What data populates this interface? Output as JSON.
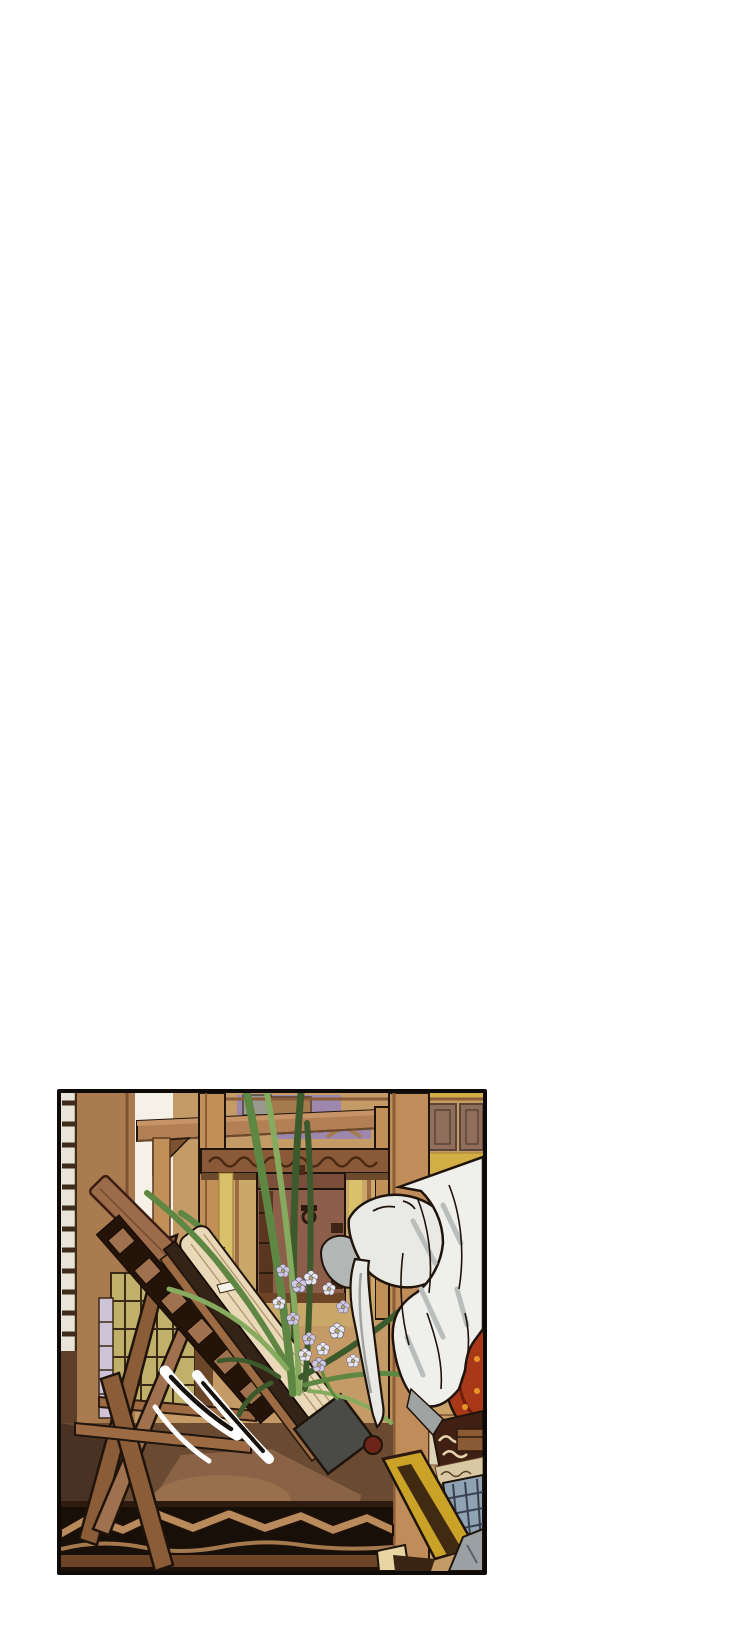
{
  "page": {
    "kind": "webtoon-episode-page",
    "background": "#ffffff"
  },
  "panel": {
    "kind": "comic-illustration-panel",
    "description": "A pale gloved hand reaches down to touch a thick closed book resting on a tilted wooden reading stand; long orchid leaves and small white and lavender flowers rise behind it inside a traditional wooden room with shelves, a latticed screen, a storage chest, a carved table edge, a yellow stool and an embroidered red object.",
    "border_color": "#0d0a07"
  },
  "scene": {
    "elements": [
      {
        "name": "lattice-screen",
        "label": "narrow white lattice screen on far left wall"
      },
      {
        "name": "wood-wall",
        "label": "brown wooden wall and pillar"
      },
      {
        "name": "white-wall",
        "label": "pale plaster wall strip"
      },
      {
        "name": "display-shelf",
        "label": "high wooden display shelf with boxes"
      },
      {
        "name": "stacked-boxes",
        "label": "gray, brown and purple boxes on the shelf"
      },
      {
        "name": "carved-frieze",
        "label": "carved scroll frieze under the shelf"
      },
      {
        "name": "storage-chest",
        "label": "dark wooden chest with metal fittings"
      },
      {
        "name": "wooden-column",
        "label": "tall foreground wooden column"
      },
      {
        "name": "paneled-wall",
        "label": "inset square wall panels over yellow band"
      },
      {
        "name": "orchid-plant",
        "label": "long arching orchid leaves"
      },
      {
        "name": "orchid-flowers",
        "label": "small white and lavender blossoms"
      },
      {
        "name": "reading-stand",
        "label": "tilted A-frame wooden book stand"
      },
      {
        "name": "book",
        "label": "thick closed book with cream page edges and dark cover"
      },
      {
        "name": "book-end-cap",
        "label": "dark gray tail end of the book"
      },
      {
        "name": "red-knob",
        "label": "small dark-red knob on the stand ledge"
      },
      {
        "name": "paper-tag",
        "label": "small white slip on the stand"
      },
      {
        "name": "motion-lines",
        "label": "white speed swooshes"
      },
      {
        "name": "reaching-hand",
        "label": "pale hand with extended index finger"
      },
      {
        "name": "white-sleeve",
        "label": "draped white sleeve"
      },
      {
        "name": "floor",
        "label": "brown floor with warm light patch"
      },
      {
        "name": "carved-table-edge",
        "label": "ornate carved wooden edge band"
      },
      {
        "name": "yellow-stool",
        "label": "slanted yellow stool"
      },
      {
        "name": "embroidered-red-object",
        "label": "round red object with orange dots"
      },
      {
        "name": "scroll-band",
        "label": "dark band with cream scrollwork"
      },
      {
        "name": "blue-lattice",
        "label": "blue-gray lattice window"
      },
      {
        "name": "robe-corner",
        "label": "gray robe fabric in bottom-right corner"
      }
    ]
  },
  "palette": {
    "paper": "#ffffff",
    "border": "#0d0a07",
    "ink": "#1f140b",
    "wallTan": "#c49a66",
    "wallBrown": "#ab7b50",
    "wallSeam": "#7d5233",
    "latticeCell": "#e9e4d8",
    "latticeSlat": "#3f2d1c",
    "lowerWallDark": "#5c3e29",
    "whiteWall": "#f6f1e6",
    "purpleWall": "#9d87ac",
    "grayBox": "#9a998f",
    "brownBox": "#a57b4e",
    "shelfWood": "#b28054",
    "shelfHighlight": "#c79468",
    "shelfShadow": "#6e4a2c",
    "postWood": "#c19058",
    "friezeWood": "#8a5a38",
    "friezeDark": "#4a2a14",
    "cabinetBg": "#c9a86a",
    "yellowStrip": "#d9c06a",
    "chestWood": "#8d5f4a",
    "chestDark": "#5a3520",
    "chestIron": "#2e1a0e",
    "columnWood": "#c08d5a",
    "columnShade": "#8a5c38",
    "yellowWall": "#d2ae45",
    "panelSquare": "#8f6f5c",
    "panelSquareDark": "#5c4436",
    "tanStrip": "#b9895c",
    "oliveDoor": "#c0b06a",
    "oliveBar": "#3a2a18",
    "lavenderStrip": "#cfc3d8",
    "doorGap": "#6b4629",
    "sillWood": "#9c6b43",
    "bookPages": "#ead9b9",
    "bookPageLine": "#b09468",
    "bookCover": "#332417",
    "bookEndCap": "#4a4a46",
    "standWood": "#a0714f",
    "standWoodDark": "#8a5c38",
    "plankWood": "#9c6b4a",
    "plankEdge": "#7a4a30",
    "openworkDark": "#241309",
    "knobRed": "#6b2417",
    "tagWhite": "#f5f2ea",
    "leaf": "#5d8743",
    "leafDark": "#3c5a2c",
    "leafLight": "#86ab5f",
    "flowerWhite": "#e8e6ee",
    "flowerLavender": "#cfc8e2",
    "flowerCenter": "#b0a86a",
    "handSkin": "#e9e9e5",
    "handShadow": "#b2b6b4",
    "handShade": "#9fa3a1",
    "sleeveWhite": "#efefec",
    "sleeveStreak": "#b9bdbb",
    "floorBrown": "#6b4a32",
    "floorShadow": "#493223",
    "floorPatch": "#8a6347",
    "floorHighlight": "#9c7350",
    "carveBandBg": "#170f08",
    "carveBandWood": "#b98a5c",
    "carveBase": "#6e4426",
    "stoolYellow": "#c9a227",
    "stoolDark": "#402a12",
    "creamBlock": "#e8d5a3",
    "redObject": "#a83818",
    "redDot": "#e8962a",
    "redRing": "#701f0c",
    "scrollBandBg": "#3f2012",
    "scrollCream": "#e6d5ae",
    "creamRow": "#d8c9a4",
    "blueLattice": "#8fa3b5",
    "blueLatticeDark": "#39404d",
    "robeGray": "#9aa0a4",
    "swooshCore": "#15100c",
    "miniBox": "#8a5a35"
  }
}
